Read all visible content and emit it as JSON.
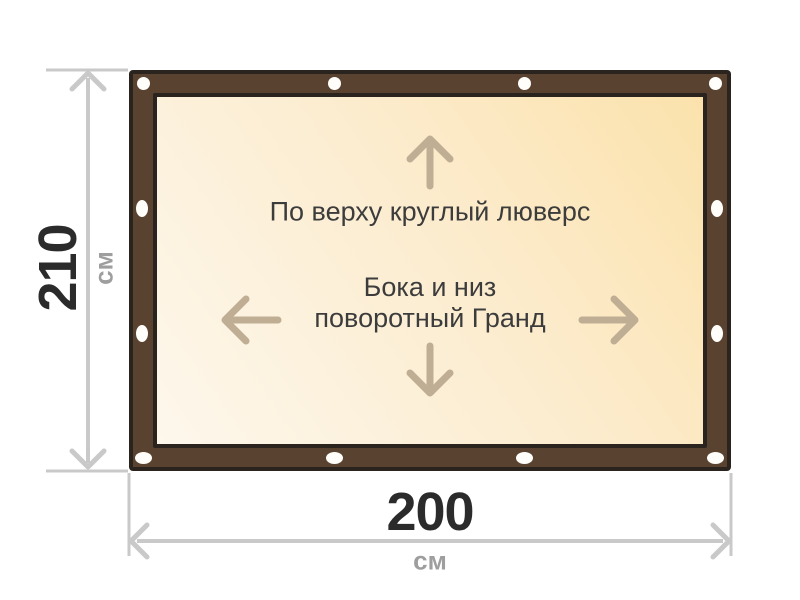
{
  "banner": {
    "top_note": "По верху круглый люверс",
    "center_note_line1": "Бока и низ",
    "center_note_line2": "поворотный Гранд",
    "grommets": [
      {
        "cx": 143,
        "cy": 83,
        "shape": "circle"
      },
      {
        "cx": 334,
        "cy": 83,
        "shape": "circle"
      },
      {
        "cx": 524,
        "cy": 83,
        "shape": "circle"
      },
      {
        "cx": 715,
        "cy": 83,
        "shape": "circle"
      },
      {
        "cx": 142,
        "cy": 208,
        "shape": "oval-v"
      },
      {
        "cx": 142,
        "cy": 333,
        "shape": "oval-v"
      },
      {
        "cx": 717,
        "cy": 208,
        "shape": "oval-v"
      },
      {
        "cx": 717,
        "cy": 333,
        "shape": "oval-v"
      },
      {
        "cx": 143,
        "cy": 458,
        "shape": "oval-h"
      },
      {
        "cx": 334,
        "cy": 458,
        "shape": "oval-h"
      },
      {
        "cx": 524,
        "cy": 458,
        "shape": "oval-h"
      },
      {
        "cx": 715,
        "cy": 458,
        "shape": "oval-h"
      }
    ]
  },
  "dimensions": {
    "height": {
      "value": "210",
      "unit": "см"
    },
    "width": {
      "value": "200",
      "unit": "см"
    }
  },
  "colors": {
    "frame_brown": "#5a4231",
    "frame_outline": "#2a231e",
    "panel_gradient_start": "#fdf7ec",
    "panel_gradient_end": "#fbe2ac",
    "grommet": "#fffefa",
    "dimension_gray": "#c9c9c9",
    "dimension_text": "#2b2b2b",
    "unit_gray": "#9e9e9e",
    "note_text": "#3c3c3c",
    "inner_arrow": "#bfae94"
  }
}
